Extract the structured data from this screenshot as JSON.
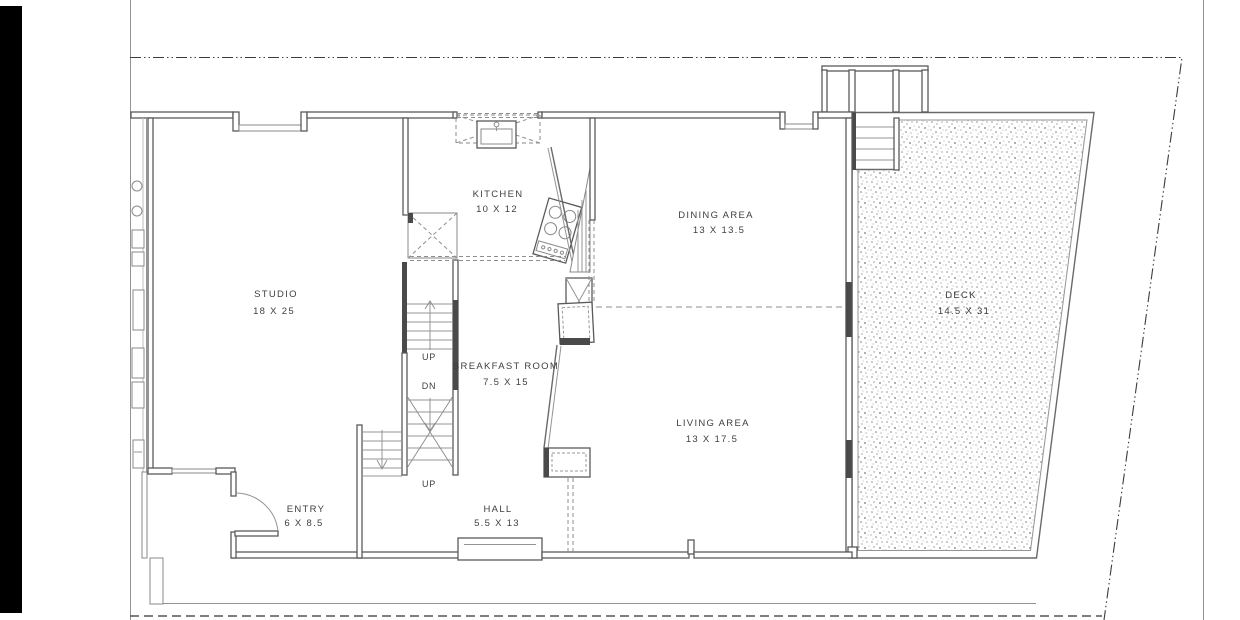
{
  "drawing": {
    "type": "architectural floor plan",
    "rooms": [
      {
        "name": "STUDIO",
        "dimensions": "18 X 25"
      },
      {
        "name": "KITCHEN",
        "dimensions": "10 X 12"
      },
      {
        "name": "DINING AREA",
        "dimensions": "13 X 13.5"
      },
      {
        "name": "BREAKFAST ROOM",
        "dimensions": "7.5 X 15"
      },
      {
        "name": "LIVING AREA",
        "dimensions": "13 X 17.5"
      },
      {
        "name": "DECK",
        "dimensions": "14.5 X 31"
      },
      {
        "name": "ENTRY",
        "dimensions": "6 X 8.5"
      },
      {
        "name": "HALL",
        "dimensions": "5.5 X 13"
      }
    ],
    "stair_labels": [
      {
        "label": "UP"
      },
      {
        "label": "DN"
      },
      {
        "label": "UP"
      }
    ],
    "colors": {
      "background": "#ffffff",
      "wall_line": "#5a5a5a",
      "thin_line": "#949494",
      "text": "#3f3f3f",
      "deck_speckle": "#8c8c8c",
      "film_edge": "#000000"
    }
  }
}
